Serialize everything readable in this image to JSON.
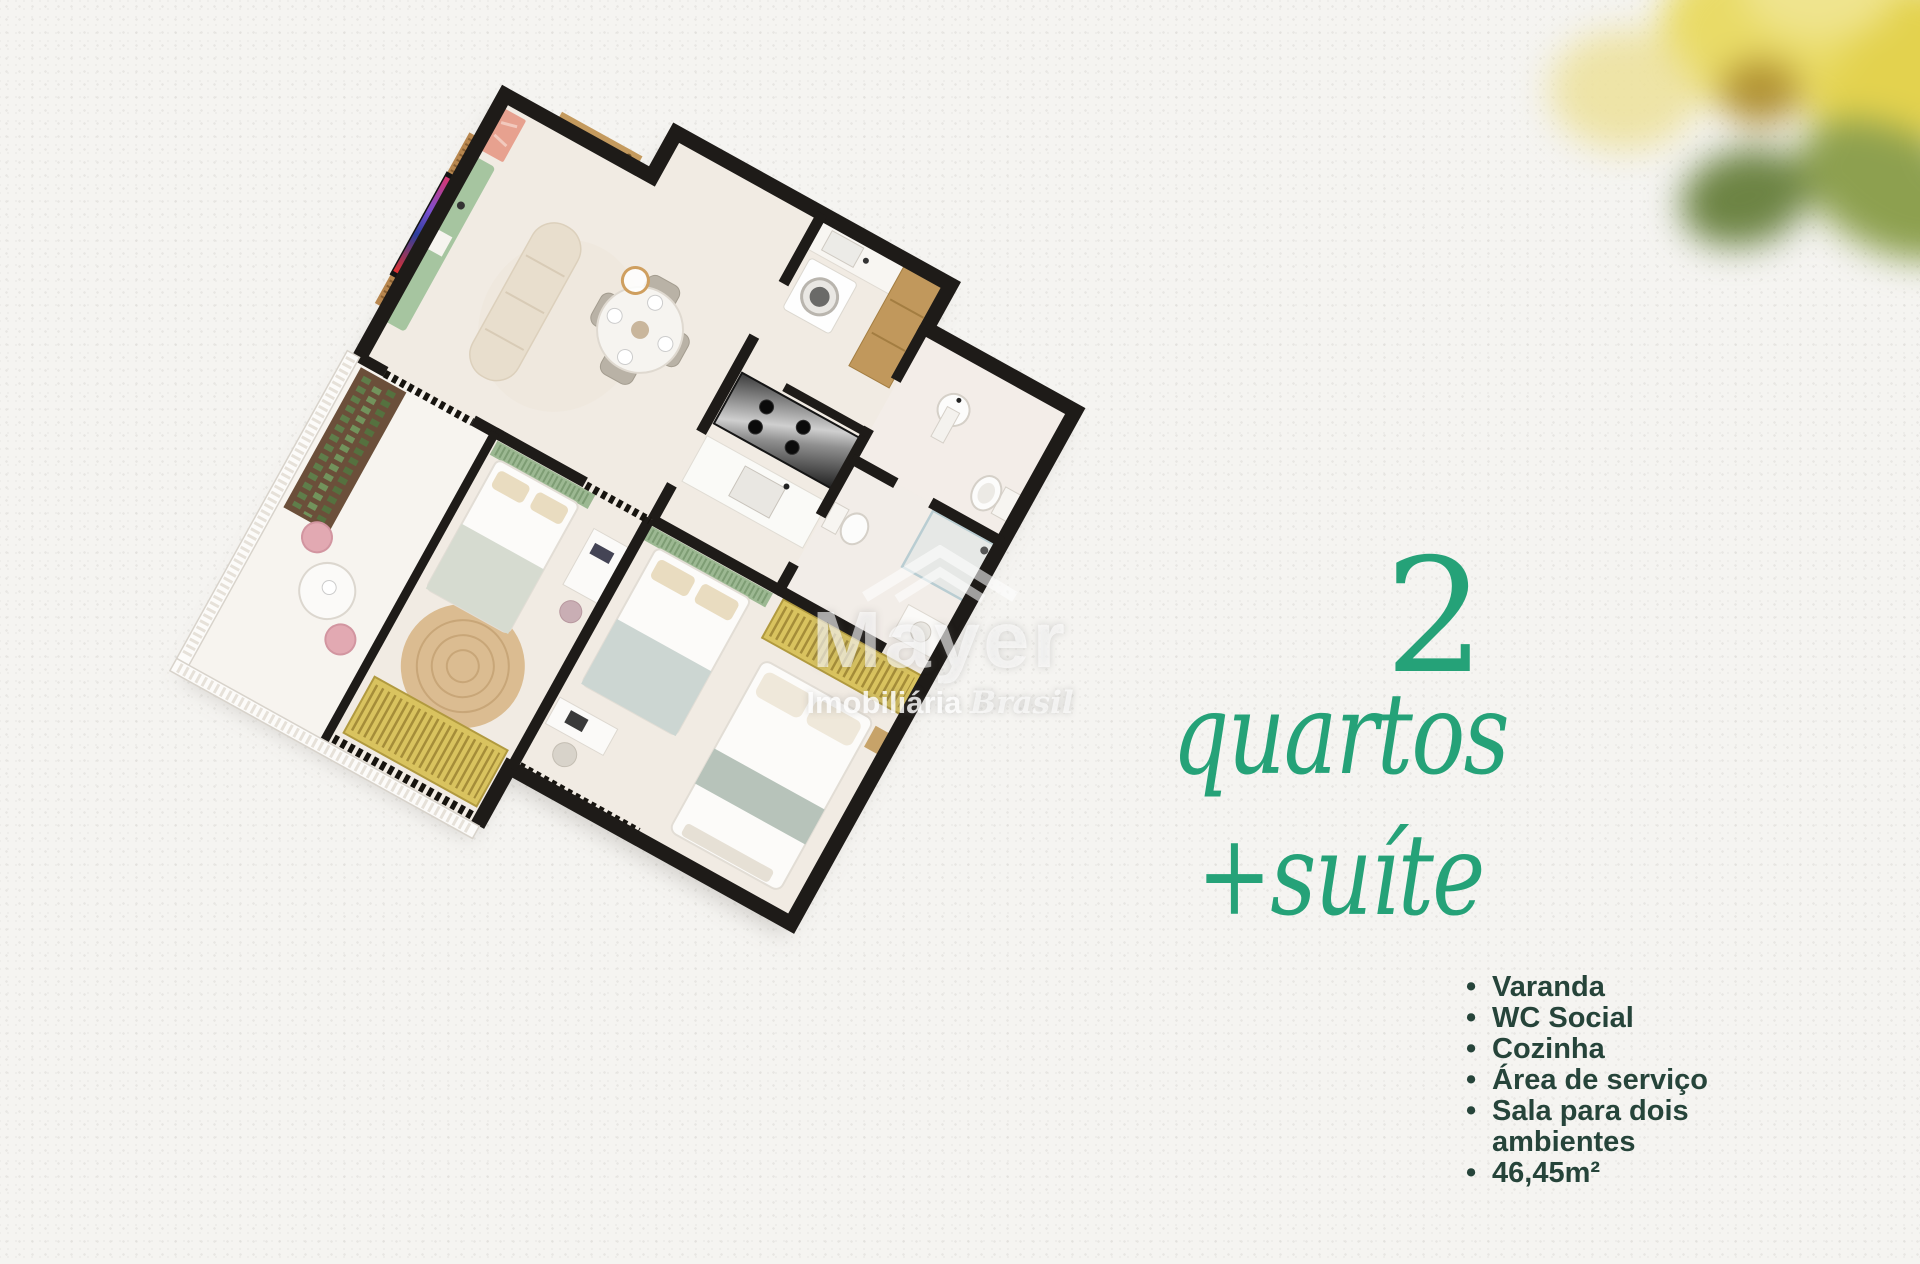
{
  "page": {
    "width": 1920,
    "height": 1264,
    "background": "#f5f4f1"
  },
  "headline": {
    "number": "2",
    "word1": "quartos",
    "word2": "+suíte",
    "color": "#25a278"
  },
  "features": {
    "color": "#26443a",
    "items": [
      "Varanda",
      "WC Social",
      "Cozinha",
      "Área de serviço",
      "Sala para dois ambientes",
      "46,45m²"
    ]
  },
  "watermark": {
    "brand": "Mayer",
    "subtitle_word1": "Imobiliária",
    "subtitle_word2": "Brasil"
  },
  "floorplan": {
    "rooms_depicted": [
      "Sala para dois ambientes",
      "Varanda",
      "Área de serviço",
      "Cozinha",
      "WC Social",
      "Quarto 1",
      "Quarto 2",
      "Suíte",
      "Banheiro da suíte"
    ],
    "wall_color": "#1e1b18",
    "floor_color": "#f1ebe3",
    "wood_color": "#c49a5e",
    "green_furniture_color": "#a6c5a0",
    "headboard_green_color": "#9cb892",
    "wardrobe_yellow_color": "#d9c35f",
    "pink_chair_color": "#e2a9b2",
    "rug_jute_color": "#d9b98c"
  },
  "decor": {
    "flower_colors": [
      "#e9db67",
      "#e3d24e",
      "#8da04f",
      "#6d8444"
    ]
  }
}
